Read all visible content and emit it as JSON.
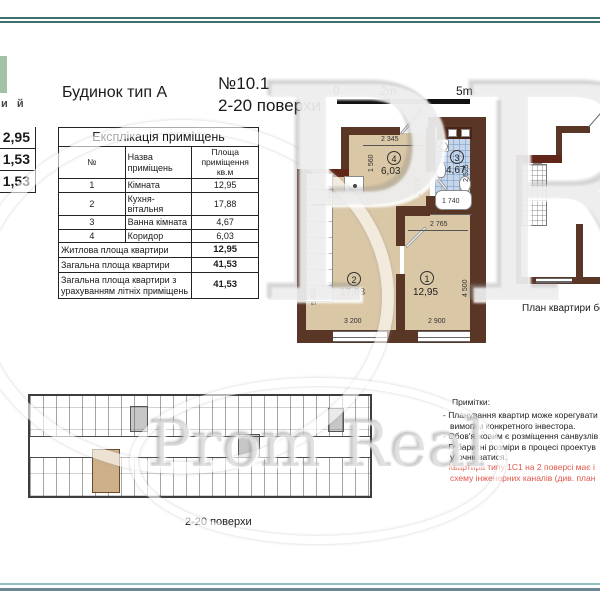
{
  "header": {
    "building_type": "Будинок тип А",
    "plan_no": "№10.1",
    "floors": "2-20 поверхи"
  },
  "logo_fragment": "и й",
  "side_values": {
    "v1": "2,95",
    "v2": "1,53",
    "v3": "1,53"
  },
  "explication": {
    "title": "Експлікація приміщень",
    "col_no": "№",
    "col_name": "Назва приміщень",
    "col_area": "Площа приміщення кв.м",
    "rows": [
      {
        "no": "1",
        "name": "Кімната",
        "area": "12,95"
      },
      {
        "no": "2",
        "name": "Кухня-вітальня",
        "area": "17,88"
      },
      {
        "no": "3",
        "name": "Ванна кімната",
        "area": "4,67"
      },
      {
        "no": "4",
        "name": "Коридор",
        "area": "6,03"
      }
    ],
    "summary": [
      {
        "name": "Житлова площа квартири",
        "area": "12,95"
      },
      {
        "name": "Загальна площа квартири",
        "area": "41,53"
      },
      {
        "name": "Загальна площа квартири з урахуванням літніх приміщень",
        "area": "41,53"
      }
    ]
  },
  "scale": {
    "t0": "0",
    "t2": "2m",
    "t5": "5m"
  },
  "plan": {
    "rooms": {
      "r1": {
        "num": "1",
        "area": "12,95"
      },
      "r2": {
        "num": "2",
        "area": "17,88"
      },
      "r3": {
        "num": "3",
        "area": "4,67"
      },
      "r4": {
        "num": "4",
        "area": "6,03"
      }
    },
    "dims": {
      "corridor_top": "2 345",
      "corridor_left": "1 560",
      "corridor_right": "2 915",
      "bath_right": "2 525",
      "bathtub": "1 740",
      "kitchen": "2 015",
      "room1_top": "2 765",
      "room1_right": "4 500",
      "room2_left": "5 880",
      "room2_bottom": "3 200",
      "room1_bottom": "2 900"
    }
  },
  "right_plan": {
    "caption": "План квартири без м"
  },
  "notes": {
    "title": "Примітки:",
    "lines": [
      {
        "text": "- Планування квартир може корегувати"
      },
      {
        "text": "вимогам конкретного інвестора."
      },
      {
        "text": "- Обов'язковим є розміщення санвузлів"
      },
      {
        "text": "- Габаритні розміри в процесі проектув"
      },
      {
        "text": "уточнюватися."
      },
      {
        "text": "- Квартира типу 1С1 на 2 поверсі має і"
      },
      {
        "text": "схему інженерних каналів (див. план"
      }
    ]
  },
  "bottom_plan": {
    "caption": "2-20 поверхи"
  },
  "watermark": {
    "initials": "PR",
    "name": "Prom Real"
  }
}
